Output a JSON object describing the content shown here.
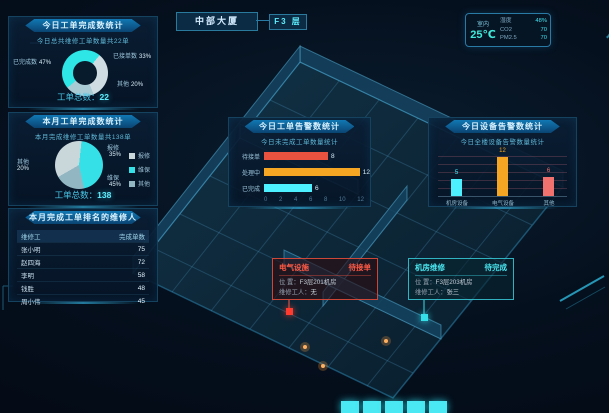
{
  "header": {
    "building": "中部大厦",
    "floor_label": "F3 层"
  },
  "env": {
    "location": "室内",
    "temperature": "25℃",
    "metrics": [
      {
        "label": "湿度",
        "value": "48%"
      },
      {
        "label": "CO2",
        "value": "70"
      },
      {
        "label": "PM2.5",
        "value": "70"
      }
    ]
  },
  "donut": {
    "title": "今日工单完成数统计",
    "subtitle": "今日总共维修工单数量共22单",
    "slices": [
      {
        "label": "已完成数",
        "pct": "47%",
        "color": "#2ee6e6"
      },
      {
        "label": "已接单数",
        "pct": "33%",
        "color": "#cfdde2"
      },
      {
        "label": "其他",
        "pct": "20%",
        "color": "#a9cbd4"
      }
    ],
    "total_label": "工单总数：",
    "total_value": "22"
  },
  "pie": {
    "title": "本月工单完成数统计",
    "subtitle": "本月完成维修工单数量共138单",
    "slices": [
      {
        "label": "报修",
        "pct": "35%",
        "color": "#c9d6da"
      },
      {
        "label": "维保",
        "pct": "45%",
        "color": "#35e0e6"
      },
      {
        "label": "其他",
        "pct": "20%",
        "color": "#93b7c2"
      }
    ],
    "total_label": "工单总数：",
    "total_value": "138"
  },
  "ranking": {
    "title": "本月完成工单排名的维修人员",
    "columns": [
      "维修工",
      "完成单数"
    ],
    "rows": [
      {
        "name": "张小明",
        "count": "75"
      },
      {
        "name": "赵四海",
        "count": "72"
      },
      {
        "name": "李明",
        "count": "58"
      },
      {
        "name": "钱胜",
        "count": "48"
      },
      {
        "name": "周小伟",
        "count": "45"
      }
    ]
  },
  "bars_today": {
    "title": "今日工单告警数统计",
    "subtitle": "今日未完成工单数量统计",
    "bars": [
      {
        "label": "待接单",
        "value": 8,
        "color": "#e8523f"
      },
      {
        "label": "处理中",
        "value": 12,
        "color": "#f5a623"
      },
      {
        "label": "已完成",
        "value": 6,
        "color": "#4df0ff"
      }
    ],
    "x_ticks": [
      "0",
      "2",
      "4",
      "6",
      "8",
      "10",
      "12"
    ]
  },
  "bars_device": {
    "title": "今日设备告警数统计",
    "subtitle": "今日全楼设备告警数量统计",
    "bars": [
      {
        "label": "机房设备",
        "value": 5,
        "color": "#4df0ff"
      },
      {
        "label": "电气设备",
        "value": 12,
        "color": "#f5a623"
      },
      {
        "label": "其他",
        "value": 6,
        "color": "#f0716d"
      }
    ]
  },
  "alerts": [
    {
      "title": "电气设施",
      "status": "待接单",
      "rows": [
        {
          "label": "位  置：",
          "value": "F3层201机房"
        },
        {
          "label": "维修工人：",
          "value": "无"
        }
      ]
    },
    {
      "title": "机房维修",
      "status": "待完成",
      "rows": [
        {
          "label": "位  置：",
          "value": "F3层203机房"
        },
        {
          "label": "维修工人：",
          "value": "张三"
        }
      ]
    }
  ],
  "chart_data": [
    {
      "type": "pie",
      "title": "今日工单完成数统计",
      "categories": [
        "已完成数",
        "已接单数",
        "其他"
      ],
      "values": [
        47,
        33,
        20
      ],
      "unit": "%",
      "center_total": 22
    },
    {
      "type": "pie",
      "title": "本月工单完成数统计",
      "categories": [
        "报修",
        "维保",
        "其他"
      ],
      "values": [
        35,
        45,
        20
      ],
      "unit": "%",
      "center_total": 138,
      "legend_position": "right"
    },
    {
      "type": "bar",
      "orientation": "horizontal",
      "title": "今日工单告警数统计",
      "categories": [
        "待接单",
        "处理中",
        "已完成"
      ],
      "values": [
        8,
        12,
        6
      ],
      "xlim": [
        0,
        12
      ],
      "x_ticks": [
        0,
        2,
        4,
        6,
        8,
        10,
        12
      ]
    },
    {
      "type": "bar",
      "orientation": "vertical",
      "title": "今日设备告警数统计",
      "categories": [
        "机房设备",
        "电气设备",
        "其他"
      ],
      "values": [
        5,
        12,
        6
      ],
      "grid": true
    },
    {
      "type": "table",
      "title": "本月完成工单排名的维修人员",
      "columns": [
        "维修工",
        "完成单数"
      ],
      "rows": [
        [
          "张小明",
          75
        ],
        [
          "赵四海",
          72
        ],
        [
          "李明",
          58
        ],
        [
          "钱胜",
          48
        ],
        [
          "周小伟",
          45
        ]
      ]
    }
  ]
}
